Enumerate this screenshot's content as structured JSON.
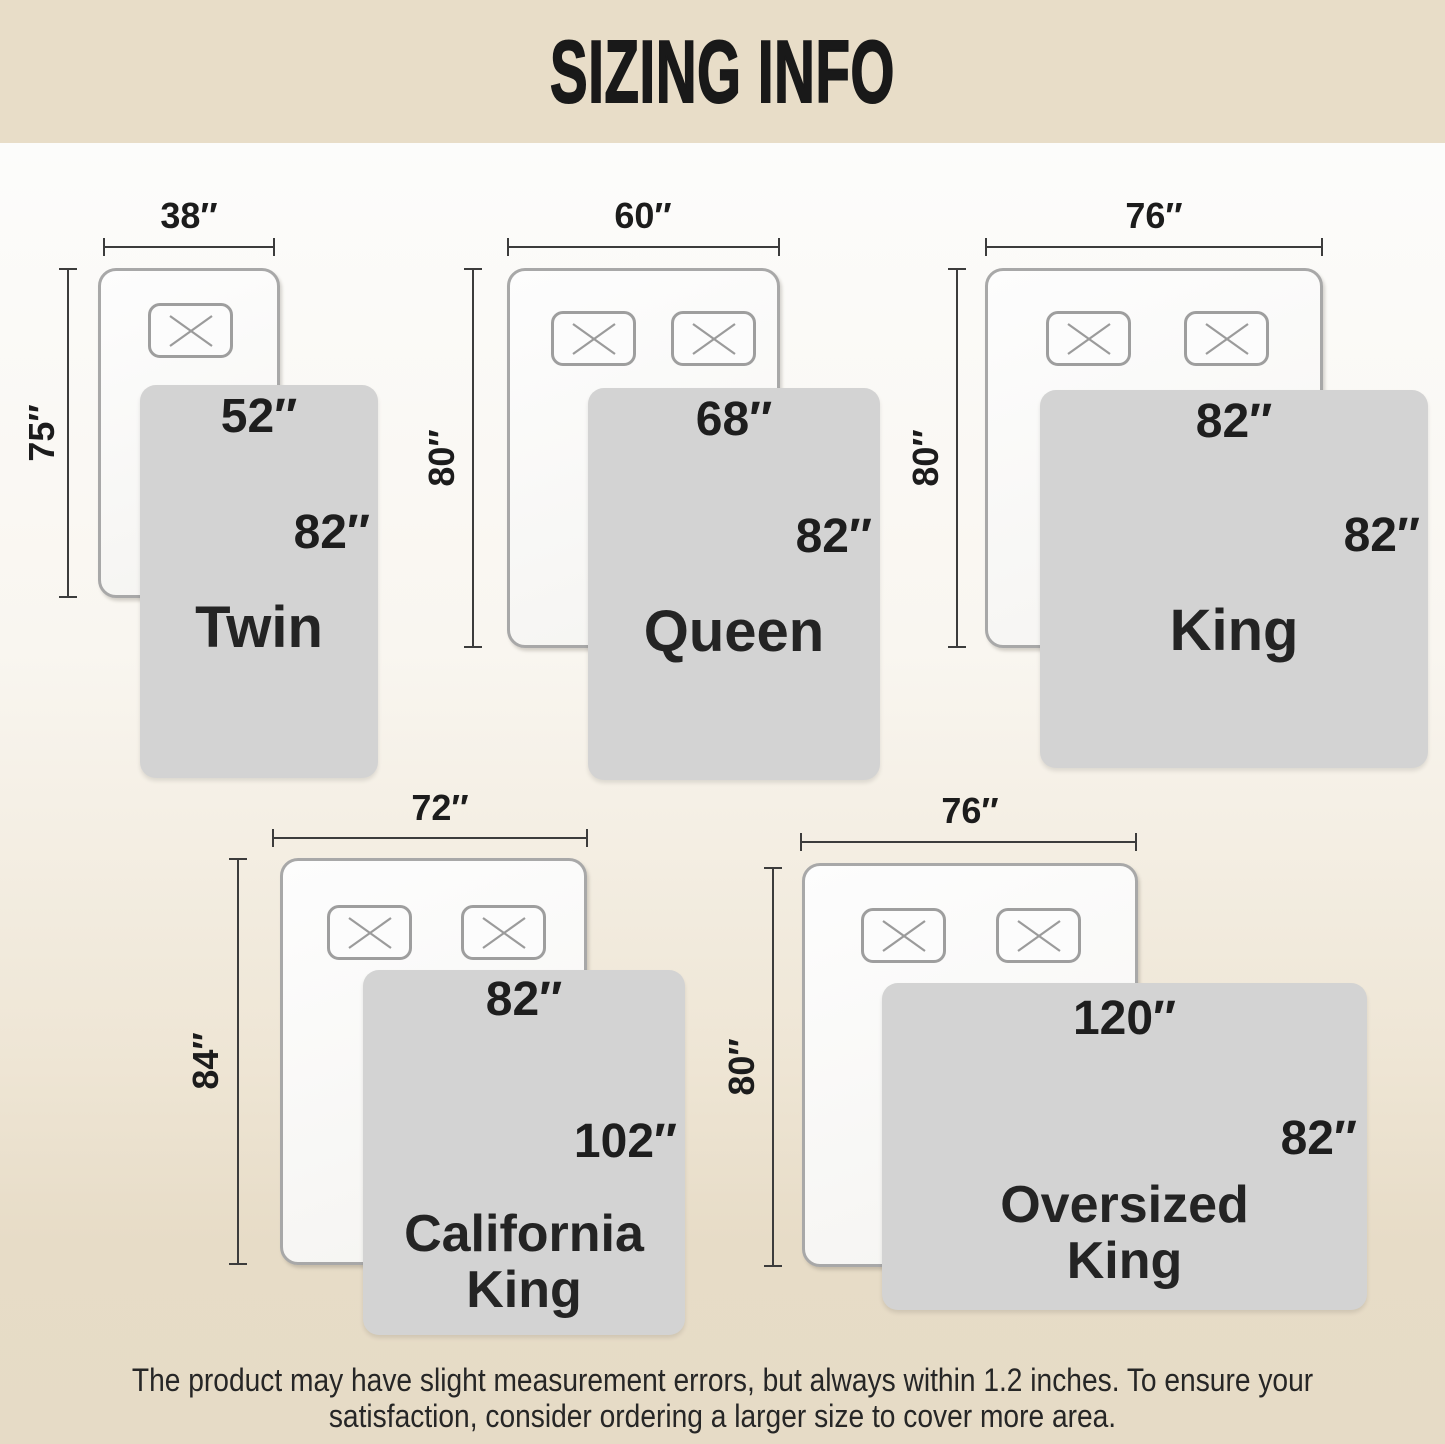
{
  "title": "SIZING INFO",
  "colors": {
    "band_beige": "#e8ddc8",
    "background_top": "#fcfcfb",
    "background_bottom": "#e6dbc6",
    "blanket_gray": "#d3d3d3",
    "bed_border_gray": "#a8a8a8",
    "dimension_line": "#3c3c3c",
    "text_dark": "#1c1c1c"
  },
  "sizes": [
    {
      "name_line1": "Twin",
      "name_line2": "",
      "bed_width": "38″",
      "bed_length": "75″",
      "blanket_width": "52″",
      "blanket_length": "82″",
      "pillows": 1
    },
    {
      "name_line1": "Queen",
      "name_line2": "",
      "bed_width": "60″",
      "bed_length": "80″",
      "blanket_width": "68″",
      "blanket_length": "82″",
      "pillows": 2
    },
    {
      "name_line1": "King",
      "name_line2": "",
      "bed_width": "76″",
      "bed_length": "80″",
      "blanket_width": "82″",
      "blanket_length": "82″",
      "pillows": 2
    },
    {
      "name_line1": "California",
      "name_line2": "King",
      "bed_width": "72″",
      "bed_length": "84″",
      "blanket_width": "82″",
      "blanket_length": "102″",
      "pillows": 2
    },
    {
      "name_line1": "Oversized",
      "name_line2": "King",
      "bed_width": "76″",
      "bed_length": "80″",
      "blanket_width": "120″",
      "blanket_length": "82″",
      "pillows": 2
    }
  ],
  "footer": {
    "line1": "The product may have slight measurement errors, but always within 1.2 inches. To ensure your",
    "line2": "satisfaction, consider ordering a larger size to cover more area."
  }
}
